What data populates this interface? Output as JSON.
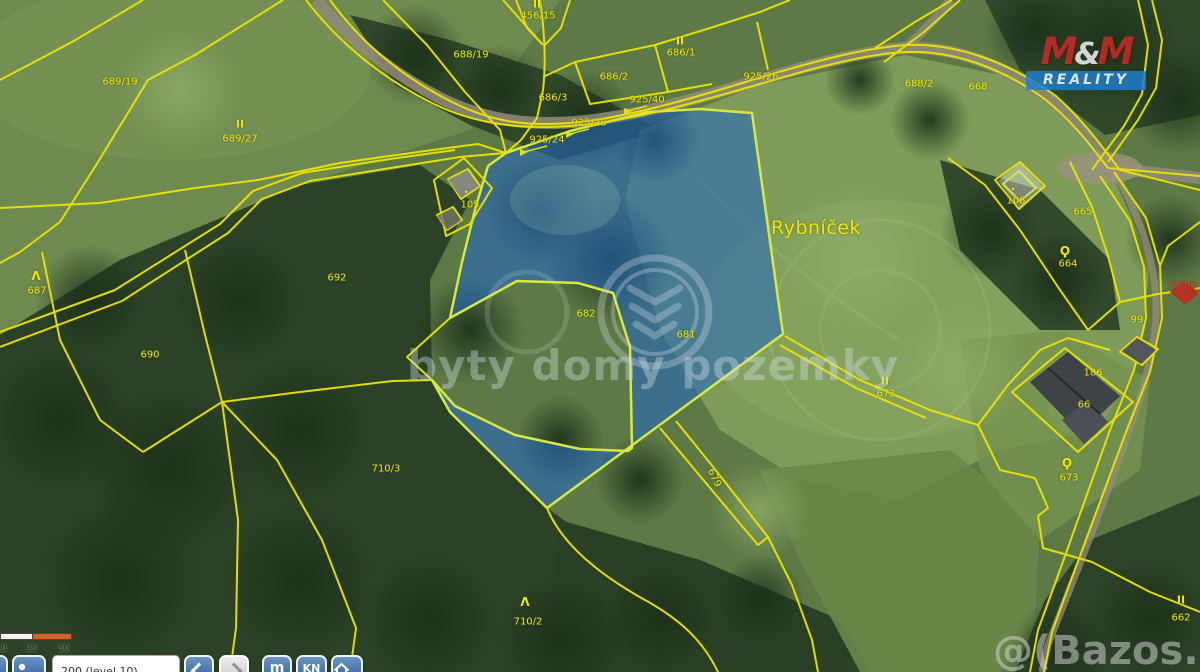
{
  "colors": {
    "parcel_line": "#ece400",
    "highlight_fill": "#2367be",
    "highlight_stroke": "#d8e840",
    "label_yellow": "#f0e800",
    "label_red": "#e8392b",
    "logo_red": "#c92a26",
    "logo_blue": "#1d7dcb",
    "scalebar_orange": "#d95f1e"
  },
  "logo": {
    "m1": "M",
    "amp": "&",
    "m2": "M",
    "subtitle": "REALITY"
  },
  "watermarks": {
    "center": "byty domy pozemky",
    "corner": "@(Bazos.cz"
  },
  "scalebar": {
    "labels": [
      "0",
      "25",
      "50 m"
    ]
  },
  "toolbar": {
    "input_value": "200 (level 10)",
    "buttons": [
      {
        "name": "edge",
        "icon": "partial-button"
      },
      {
        "name": "locate",
        "icon": "person-icon"
      },
      {
        "name": "back",
        "icon": "chevron-left-icon"
      },
      {
        "name": "forward",
        "icon": "chevron-right-icon",
        "disabled": true
      },
      {
        "name": "measure",
        "label": "m"
      },
      {
        "name": "cadastre",
        "label": "KN"
      },
      {
        "name": "home",
        "icon": "house-icon"
      }
    ]
  },
  "map": {
    "place_name": "Rybníček",
    "highlighted_parcels": [
      "681"
    ],
    "labels": [
      {
        "text": "689/19",
        "x": 120,
        "y": 82
      },
      {
        "text": "II",
        "x": 240,
        "y": 124,
        "cls": "sym2"
      },
      {
        "text": "689/27",
        "x": 240,
        "y": 139
      },
      {
        "text": "II",
        "x": 537,
        "y": 4,
        "cls": "sym2"
      },
      {
        "text": "456/15",
        "x": 538,
        "y": 16
      },
      {
        "text": "688/19",
        "x": 471,
        "y": 55
      },
      {
        "text": "686/3",
        "x": 553,
        "y": 98
      },
      {
        "text": "686/2",
        "x": 614,
        "y": 77
      },
      {
        "text": "II",
        "x": 680,
        "y": 41,
        "cls": "sym2"
      },
      {
        "text": "686/1",
        "x": 681,
        "y": 53
      },
      {
        "text": "925/24",
        "x": 547,
        "y": 140
      },
      {
        "text": "925/28",
        "x": 589,
        "y": 123
      },
      {
        "text": "925/40",
        "x": 647,
        "y": 100
      },
      {
        "text": "925/26",
        "x": 761,
        "y": 77
      },
      {
        "text": "688/2",
        "x": 919,
        "y": 84
      },
      {
        "text": "668",
        "x": 978,
        "y": 87
      },
      {
        "text": "Rybníček",
        "x": 816,
        "y": 228,
        "cls": "place"
      },
      {
        "text": "•",
        "x": 466,
        "y": 193,
        "cls": "dot"
      },
      {
        "text": "105",
        "x": 470,
        "y": 205
      },
      {
        "text": "692",
        "x": 337,
        "y": 278
      },
      {
        "text": "Λ",
        "x": 36,
        "y": 276,
        "cls": "tree"
      },
      {
        "text": "687",
        "x": 37,
        "y": 291
      },
      {
        "text": "690",
        "x": 150,
        "y": 355
      },
      {
        "text": "682",
        "x": 586,
        "y": 314
      },
      {
        "text": "681",
        "x": 686,
        "y": 335
      },
      {
        "text": "679",
        "x": 714,
        "y": 478,
        "cls": "rot"
      },
      {
        "text": "710/3",
        "x": 386,
        "y": 469
      },
      {
        "text": "Λ",
        "x": 525,
        "y": 602,
        "cls": "tree"
      },
      {
        "text": "710/2",
        "x": 528,
        "y": 622
      },
      {
        "text": "II",
        "x": 885,
        "y": 381,
        "cls": "sym2"
      },
      {
        "text": "672",
        "x": 886,
        "y": 394
      },
      {
        "text": "•",
        "x": 1013,
        "y": 190,
        "cls": "dot"
      },
      {
        "text": "108",
        "x": 1016,
        "y": 201
      },
      {
        "text": "665",
        "x": 1083,
        "y": 212
      },
      {
        "text": "Ϙ",
        "x": 1065,
        "y": 251,
        "cls": "tree"
      },
      {
        "text": "664",
        "x": 1068,
        "y": 264
      },
      {
        "text": "554/1",
        "x": 1183,
        "y": 286,
        "cls": "red"
      },
      {
        "text": "99",
        "x": 1137,
        "y": 320
      },
      {
        "text": "186",
        "x": 1093,
        "y": 373
      },
      {
        "text": "66",
        "x": 1084,
        "y": 405
      },
      {
        "text": "Ϙ",
        "x": 1067,
        "y": 463,
        "cls": "tree"
      },
      {
        "text": "673",
        "x": 1069,
        "y": 478
      },
      {
        "text": "II",
        "x": 1181,
        "y": 600,
        "cls": "sym2"
      },
      {
        "text": "662",
        "x": 1181,
        "y": 618
      }
    ]
  }
}
